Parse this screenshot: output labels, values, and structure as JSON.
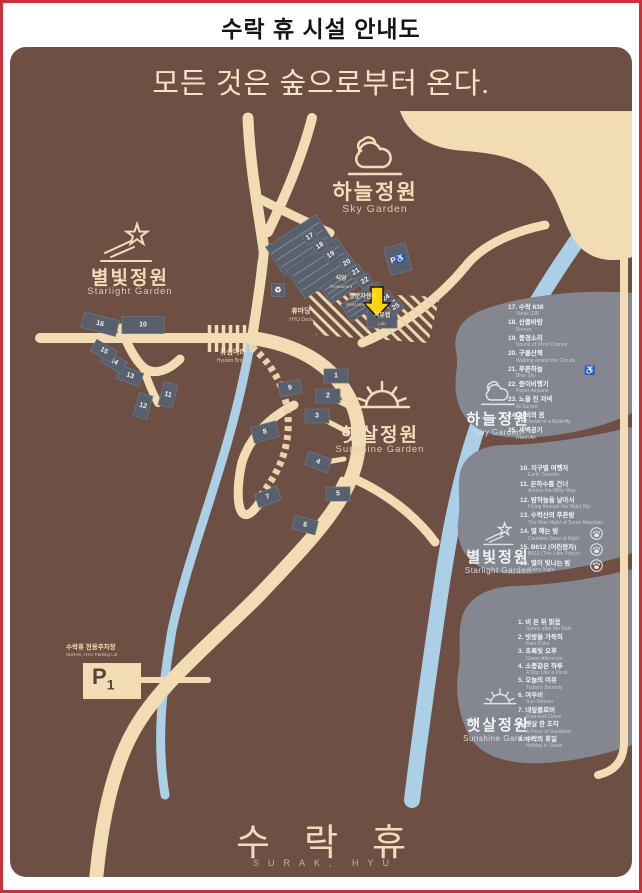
{
  "window": {
    "title": "수락 휴 시설 안내도",
    "slogan": "모든 것은 숲으로부터 온다."
  },
  "map": {
    "garden_labels": {
      "sky": {
        "ko": "하늘정원",
        "en": "Sky Garden"
      },
      "starlight": {
        "ko": "별빛정원",
        "en": "Starlight Garden"
      },
      "sunshine": {
        "ko": "햇살정원",
        "en": "Sunshine Garden"
      }
    },
    "landmarks": {
      "restaurant": {
        "ko": "식당",
        "en": "Restaurant"
      },
      "welcome_center": {
        "ko": "방문자센터",
        "en": "Welcome Center"
      },
      "lab": {
        "ko": "치유랩",
        "en": "Lab"
      },
      "hyu_deck": {
        "ko": "휴마당",
        "en": "HYU Deck"
      },
      "bridge": {
        "ko": "휴심다리",
        "en": "Hyusim Bridge"
      },
      "parking": {
        "ko": "수락휴 전용주차장",
        "en": "SURAK, HYU Parking Lot",
        "marker": "P",
        "marker_sub": "1"
      }
    },
    "icons": {
      "wheelchair": "♿",
      "recycle": "♻",
      "accessible_parking": "P♿"
    },
    "building_numbers": [
      "1",
      "2",
      "3",
      "4",
      "5",
      "6",
      "7",
      "8",
      "9",
      "10",
      "11",
      "12",
      "13",
      "14",
      "15",
      "16",
      "17",
      "18",
      "19",
      "20",
      "21",
      "22",
      "23",
      "24",
      "25"
    ]
  },
  "legend": {
    "sky": {
      "title_ko": "하늘정원",
      "title_en": "Sky Garden",
      "items": [
        {
          "no": "17",
          "ko": "수락 638",
          "en": "Surak 638"
        },
        {
          "no": "18",
          "ko": "산들바람",
          "en": "Breeze"
        },
        {
          "no": "19",
          "ko": "풍경소리",
          "en": "Sound of Wind Chimes"
        },
        {
          "no": "20",
          "ko": "구름산책",
          "en": "Walking amidst the Clouds"
        },
        {
          "no": "21",
          "ko": "푸른하늘",
          "en": "Blue Sky",
          "badge": "wheelchair"
        },
        {
          "no": "22",
          "ko": "종이비행기",
          "en": "Paper Airplane"
        },
        {
          "no": "23",
          "ko": "노을 진 저녁",
          "en": "At Sunset"
        },
        {
          "no": "24",
          "ko": "나비의 꿈",
          "en": "The Dream of a Butterfly"
        },
        {
          "no": "25",
          "ko": "새벽공기",
          "en": "Dawn Air"
        }
      ]
    },
    "starlight": {
      "title_ko": "별빛정원",
      "title_en": "Starlight Garden",
      "items": [
        {
          "no": "10",
          "ko": "지구별 여행자",
          "en": "Earth Traveler"
        },
        {
          "no": "11",
          "ko": "은하수를 건너",
          "en": "Across the Milky Way"
        },
        {
          "no": "12",
          "ko": "밤하늘을 날아서",
          "en": "Flying through the Night Sky"
        },
        {
          "no": "13",
          "ko": "수락산의 푸른밤",
          "en": "The Blue Night of Surak Mountain"
        },
        {
          "no": "14",
          "ko": "별 헤는 밤",
          "en": "Counting Stars at Night",
          "badge": "pet"
        },
        {
          "no": "15",
          "ko": "B612 (어린왕자)",
          "en": "B612 (The Little Prince)",
          "badge": "pet"
        },
        {
          "no": "16",
          "ko": "별이 빛나는 밤",
          "en": "Starry Night",
          "badge": "pet"
        }
      ]
    },
    "sunshine": {
      "title_ko": "햇살정원",
      "title_en": "Sunshine Garden",
      "items": [
        {
          "no": "1",
          "ko": "비 온 뒤 맑음",
          "en": "Sunny after the Rain"
        },
        {
          "no": "2",
          "ko": "빗방울 가득히",
          "en": "Rain Color"
        },
        {
          "no": "3",
          "ko": "초록빛 오후",
          "en": "Green Afternoon"
        },
        {
          "no": "4",
          "ko": "소풍같은 하루",
          "en": "A Day Like a Picnic"
        },
        {
          "no": "5",
          "ko": "오늘의 여유",
          "en": "Today's Serenity"
        },
        {
          "no": "6",
          "ko": "여우비",
          "en": "Sun Shower"
        },
        {
          "no": "7",
          "ko": "네잎클로버",
          "en": "Four-leaf Clover"
        },
        {
          "no": "8",
          "ko": "햇살 한 조각",
          "en": "A Piece of Sunshine"
        },
        {
          "no": "9",
          "ko": "수락의 휴일",
          "en": "Holiday in Surak"
        }
      ]
    }
  },
  "footer": {
    "logo_ko": "수락휴",
    "logo_en": "SURAK, HYU"
  }
}
